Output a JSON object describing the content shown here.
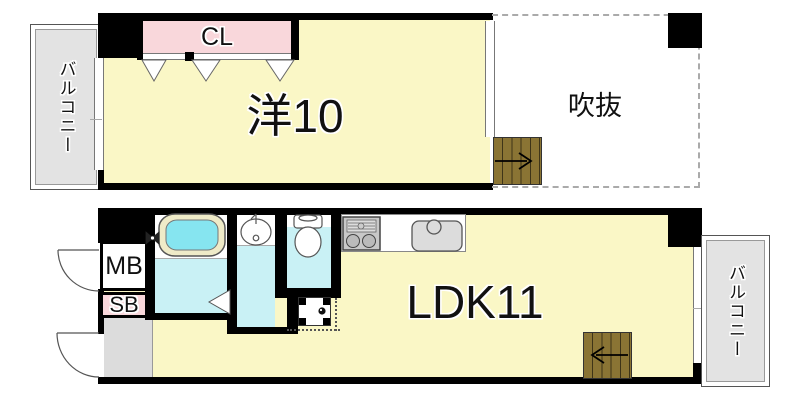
{
  "plan": {
    "upper_floor": {
      "balcony_label": "バルコニー",
      "closet_label": "CL",
      "room_label": "洋10",
      "void_label": "吹抜"
    },
    "lower_floor": {
      "meter_box_label": "MB",
      "shaft_box_label": "SB",
      "ldk_label": "LDK11",
      "balcony_label": "バルコニー"
    },
    "icons": {
      "upper_stairs_arrow": "right",
      "lower_stairs_arrow": "left"
    },
    "colors": {
      "room_fill": "#FAF7C6",
      "closet_fill": "#F9D7DB",
      "wet_area_fill": "#C9F1F5",
      "bathtub_fill": "#86E5F0",
      "bathtub_rim": "#EFEBC8",
      "balcony_fill": "#E3E3E3",
      "entrance_fill": "#DCDCDC",
      "stairs_fill": "#8A7434",
      "wall": "#000000",
      "void_dash": "#AAAAAA"
    }
  }
}
